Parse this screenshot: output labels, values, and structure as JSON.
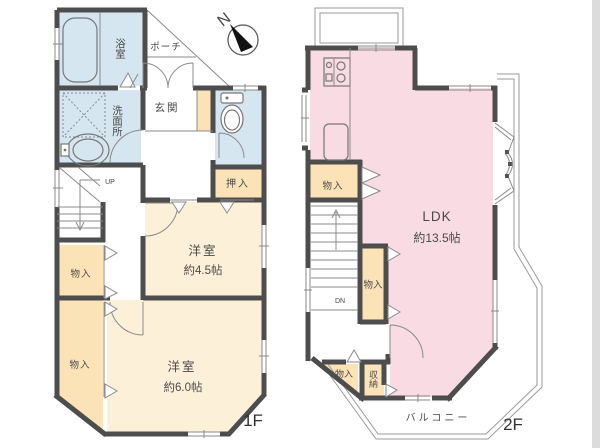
{
  "title": "2-story house floor plan",
  "compass": {
    "north": "N"
  },
  "floor1": {
    "label": "1F",
    "bathroom": "浴室",
    "porch": "ポーチ",
    "entrance": "玄関",
    "washroom": "洗面所",
    "closet_oshiire": "押入",
    "storage_upper": "物入",
    "storage_lower": "物入",
    "room1_name": "洋室",
    "room1_size": "約4.5帖",
    "room2_name": "洋室",
    "room2_size": "約6.0帖",
    "stairs_direction": "UP"
  },
  "floor2": {
    "label": "2F",
    "ldk_name": "LDK",
    "ldk_size": "約13.5帖",
    "storage_left": "物入",
    "storage_mid": "物入",
    "storage_bottom": "物入",
    "closet_shuno": "収納",
    "balcony": "バルコニー",
    "stairs_direction": "DN"
  },
  "icons": [
    "compass-icon",
    "bathtub-icon",
    "washing-machine-icon",
    "washbasin-icon",
    "toilet-icon",
    "stove-icon",
    "kitchen-sink-icon"
  ],
  "colors": {
    "wall": "#4d4d4d",
    "water_rooms": "#d5e6f0",
    "bedrooms": "#fcf0d9",
    "closets": "#fce3b7",
    "ldk": "#f8dbe3",
    "thin_lines": "#8a8a8a",
    "text": "#444444"
  }
}
